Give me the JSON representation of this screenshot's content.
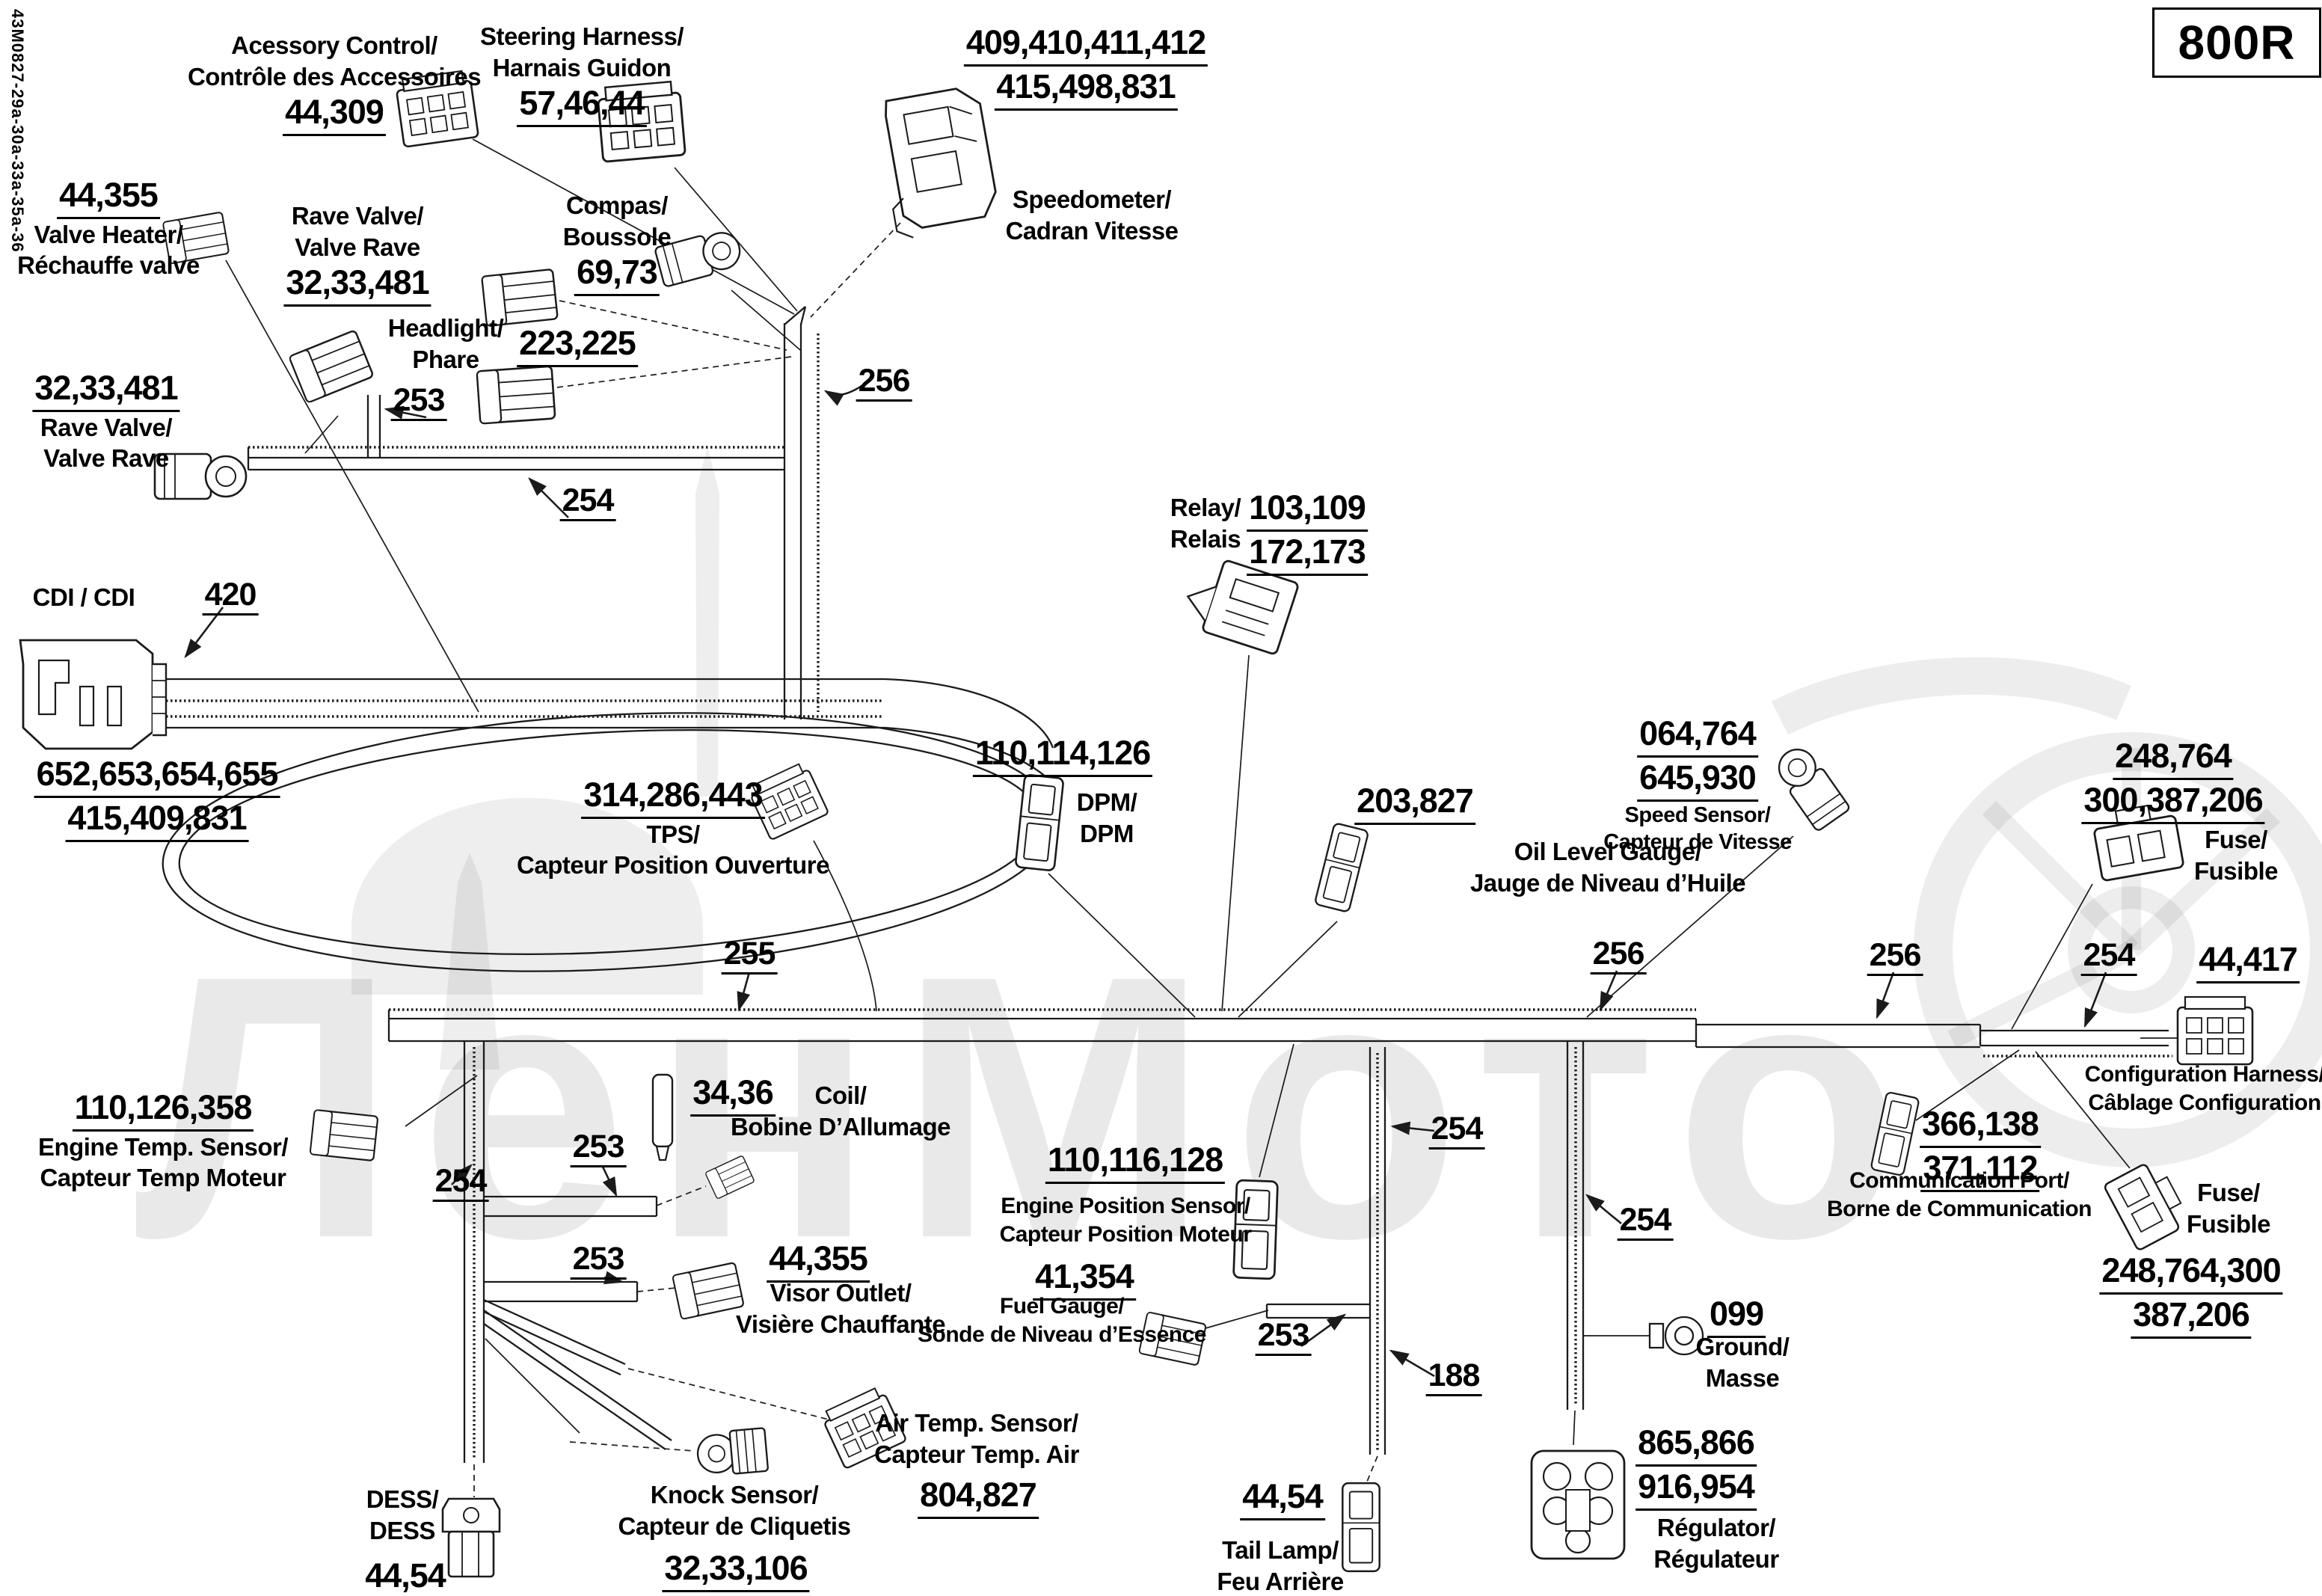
{
  "doc": {
    "model_code": "800R",
    "sheet_code": "43M0827-29a-30a-33a-35a-36",
    "watermark_text": "ЛенМото"
  },
  "wire_refs": {
    "n188": "188",
    "n253": "253",
    "n254": "254",
    "n255": "255",
    "n256": "256",
    "n420": "420"
  },
  "parts": {
    "accessory": {
      "name1": "Acessory Control/",
      "name2": "Contrôle des Accessoires",
      "num": "44,309"
    },
    "steering": {
      "name1": "Steering Harness/",
      "name2": "Harnais Guidon",
      "num": "57,46,44"
    },
    "speedometer": {
      "num1": "409,410,411,412",
      "num2": "415,498,831",
      "name1": "Speedometer/",
      "name2": "Cadran Vitesse"
    },
    "valve_heater": {
      "num": "44,355",
      "name1": "Valve Heater/",
      "name2": "Réchauffe valve"
    },
    "rave_top": {
      "name1": "Rave Valve/",
      "name2": "Valve Rave",
      "num": "32,33,481"
    },
    "compass": {
      "name1": "Compas/",
      "name2": "Boussole",
      "num": "69,73"
    },
    "headlight": {
      "name1": "Headlight/",
      "name2": "Phare",
      "num": "223,225"
    },
    "rave_left": {
      "num": "32,33,481",
      "name1": "Rave Valve/",
      "name2": "Valve Rave"
    },
    "cdi": {
      "name": "CDI / CDI",
      "num": "420",
      "num2": "652,653,654,655",
      "num3": "415,409,831"
    },
    "relay": {
      "name1": "Relay/",
      "name2": "Relais",
      "num1": "103,109",
      "num2": "172,173"
    },
    "tps": {
      "num": "314,286,443",
      "name1": "TPS/",
      "name2": "Capteur Position Ouverture"
    },
    "dpm": {
      "num": "110,114,126",
      "name1": "DPM/",
      "name2": "DPM"
    },
    "oil": {
      "num": "203,827",
      "name1": "Oil Level Gauge/",
      "name2": "Jauge de Niveau d’Huile"
    },
    "speed_sensor": {
      "num1": "064,764",
      "num2": "645,930",
      "name1": "Speed Sensor/",
      "name2": "Capteur de Vitesse"
    },
    "fuse_top": {
      "num1": "248,764",
      "num2": "300,387,206",
      "name1": "Fuse/",
      "name2": "Fusible"
    },
    "config": {
      "num": "44,417",
      "name1": "Configuration Harness/",
      "name2": "Câblage Configuration"
    },
    "comm": {
      "num1": "366,138",
      "num2": "371,112",
      "name1": "Communication Port/",
      "name2": "Borne de Communication"
    },
    "fuse_bottom": {
      "name1": "Fuse/",
      "name2": "Fusible",
      "num1": "248,764,300",
      "num2": "387,206"
    },
    "engine_temp": {
      "num": "110,126,358",
      "name1": "Engine Temp. Sensor/",
      "name2": "Capteur Temp Moteur"
    },
    "coil": {
      "num": "34,36",
      "name1": "Coil/",
      "name2": "Bobine D’Allumage"
    },
    "visor": {
      "num": "44,355",
      "name1": "Visor Outlet/",
      "name2": "Visière Chauffante"
    },
    "engine_pos": {
      "num": "110,116,128",
      "name1": "Engine Position Sensor/",
      "name2": "Capteur Position Moteur"
    },
    "fuel": {
      "num": "41,354",
      "name1": "Fuel Gauge/",
      "name2": "Sonde de Niveau d’Essence"
    },
    "ground": {
      "num": "099",
      "name1": "Ground/",
      "name2": "Masse"
    },
    "tail": {
      "num": "44,54",
      "name1": "Tail Lamp/",
      "name2": "Feu Arrière"
    },
    "regulator": {
      "num1": "865,866",
      "num2": "916,954",
      "name1": "Régulator/",
      "name2": "Régulateur"
    },
    "dess": {
      "name1": "DESS/",
      "name2": "DESS",
      "num": "44,54"
    },
    "knock": {
      "name1": "Knock Sensor/",
      "name2": "Capteur de Cliquetis",
      "num": "32,33,106"
    },
    "air_temp": {
      "name1": "Air Temp. Sensor/",
      "name2": "Capteur Temp. Air",
      "num": "804,827"
    }
  }
}
